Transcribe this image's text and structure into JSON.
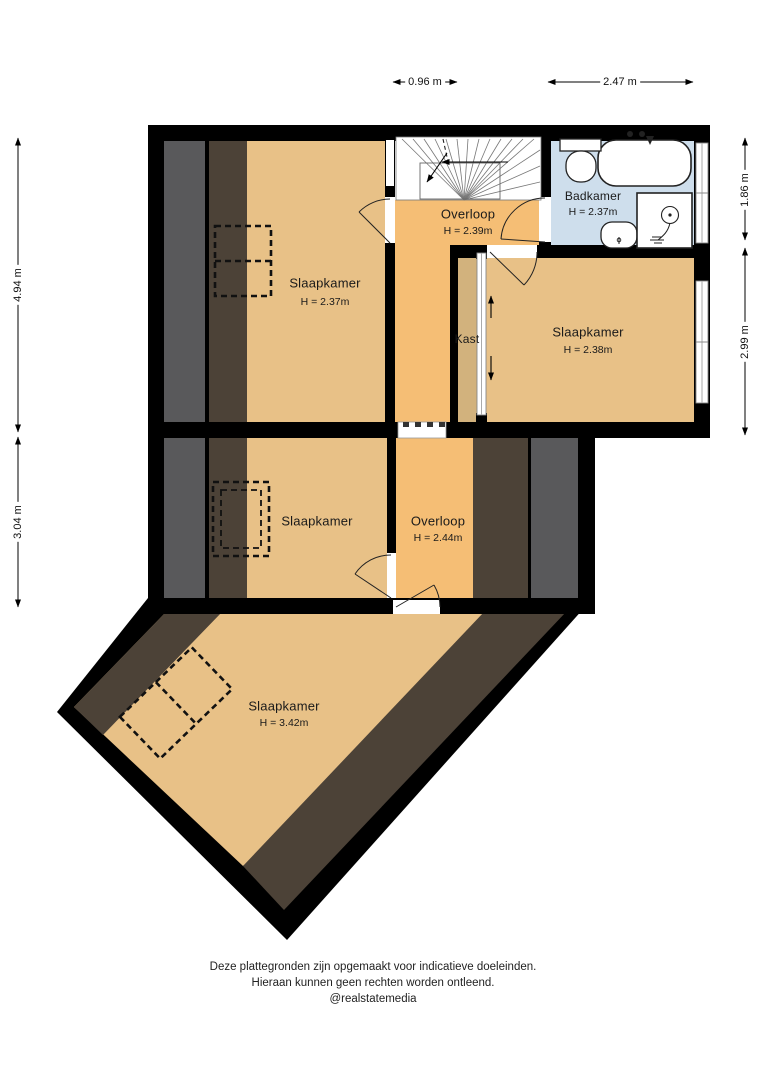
{
  "floorplan": {
    "rooms": [
      {
        "name": "Slaapkamer",
        "height": "H = 2.37m"
      },
      {
        "name": "Overloop",
        "height": "H = 2.39m"
      },
      {
        "name": "Badkamer",
        "height": "H = 2.37m"
      },
      {
        "name": "Slaapkamer",
        "height": "H = 2.38m"
      },
      {
        "name": "Kast",
        "height": ""
      },
      {
        "name": "Slaapkamer",
        "height": ""
      },
      {
        "name": "Overloop",
        "height": "H = 2.44m"
      },
      {
        "name": "Slaapkamer",
        "height": "H = 3.42m"
      }
    ],
    "dimensions": {
      "top": [
        {
          "label": "0.96 m"
        },
        {
          "label": "2.47 m"
        }
      ],
      "left": [
        {
          "label": "4.94 m"
        },
        {
          "label": "3.04 m"
        }
      ],
      "right": [
        {
          "label": "1.86 m"
        },
        {
          "label": "2.99 m"
        }
      ]
    },
    "footer": {
      "line1": "Deze plattegronden zijn opgemaakt voor indicatieve doeleinden.",
      "line2": "Hieraan kunnen geen rechten worden ontleend.",
      "line3": "@realstatemedia"
    },
    "colors": {
      "wall": "#000000",
      "room_floor": "#E8C187",
      "hall_floor": "#F5BE75",
      "closet_floor": "#D2B27D",
      "bathroom_floor": "#CEDEEC",
      "sloped_ceiling_band": "#4C4237",
      "exterior_band": "#59595B"
    }
  }
}
